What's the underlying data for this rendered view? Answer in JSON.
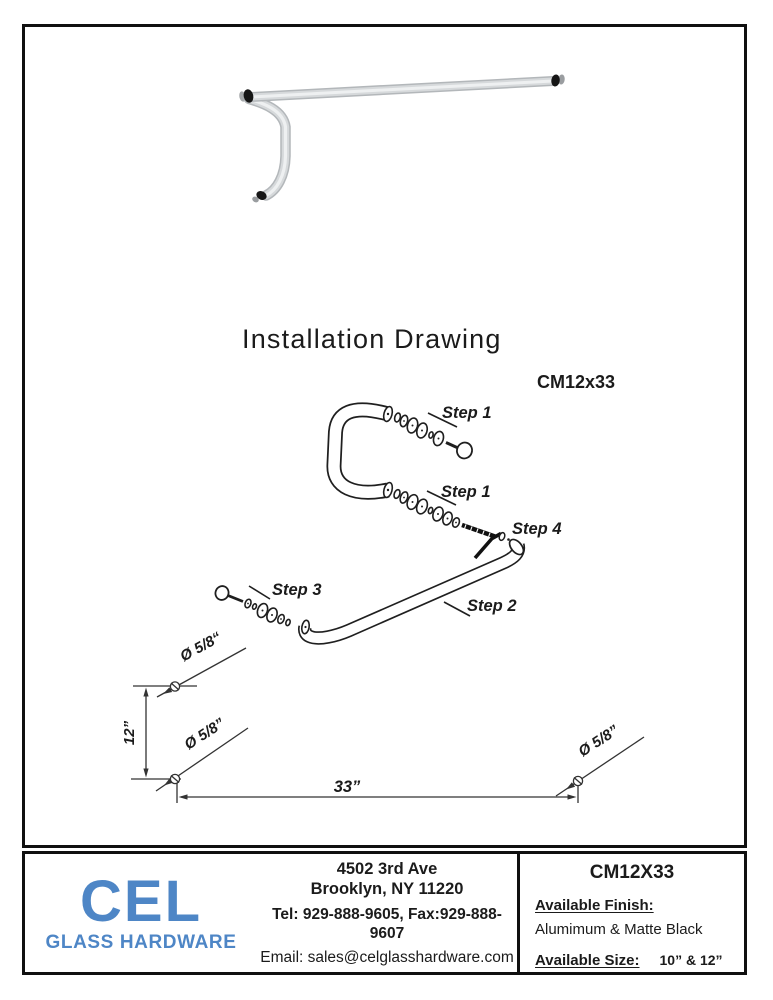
{
  "title": "Installation Drawing",
  "drawing": {
    "model_label": "CM12x33",
    "steps": {
      "step1_top": "Step 1",
      "step1_bottom": "Step 1",
      "step2": "Step 2",
      "step3": "Step 3",
      "step4": "Step 4"
    },
    "dimensions": {
      "dia_top_left": "Ø 5/8“",
      "dia_bottom_left": "Ø 5/8”",
      "dia_right": "Ø 5/8”",
      "height": "12”",
      "length": "33”"
    }
  },
  "footer": {
    "logo_text": "CEL",
    "logo_subtext": "GLASS HARDWARE",
    "logo_color": "#4e86c6",
    "address_line1": "4502 3rd Ave",
    "address_line2": "Brooklyn, NY 11220",
    "contact_line": "Tel: 929-888-9605, Fax:929-888-9607",
    "email_line": "Email: sales@celglasshardware.com",
    "product_box": {
      "model": "CM12X33",
      "finish_label": "Available Finish:",
      "finish_value": "Alumimum & Matte Black",
      "size_label": "Available Size:",
      "size_value": "10” & 12”"
    }
  }
}
